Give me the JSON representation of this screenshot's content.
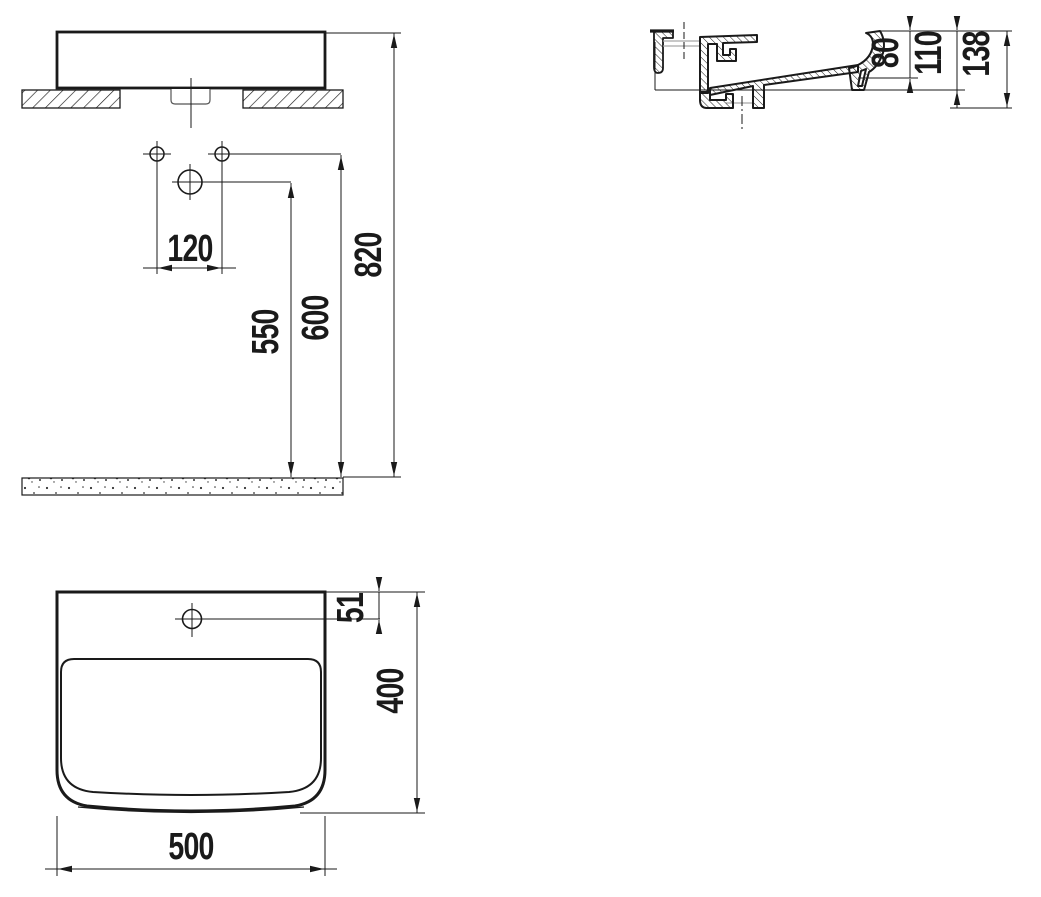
{
  "drawing": {
    "type": "washbasin-installation-technical-drawing",
    "colors": {
      "line": "#1a1a1a",
      "construction_gray": "#a6a6a6",
      "background": "#ffffff"
    },
    "views": {
      "front": "front-elevation-with-wall-and-floor",
      "section": "side-cross-section",
      "plan": "top-plan-view"
    }
  },
  "dims": {
    "front_hole_spacing": "120",
    "front_faucet_height": "550",
    "front_fixing_height": "600",
    "front_rim_height": "820",
    "section_inner_depth": "80",
    "section_mid_depth": "110",
    "section_total_depth": "138",
    "plan_faucet_offset": "51",
    "plan_depth": "400",
    "plan_width": "500"
  }
}
